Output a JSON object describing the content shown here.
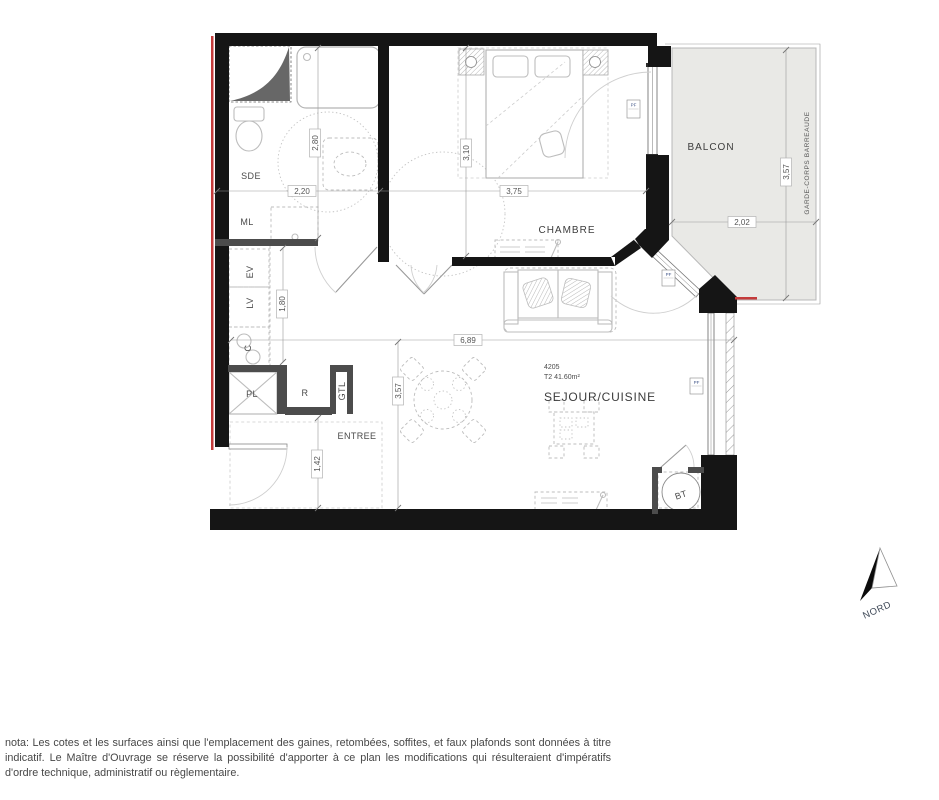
{
  "plan": {
    "unit": {
      "number": "4205",
      "type_area": "T2 41.60m²"
    },
    "rooms": {
      "balcony": "BALCON",
      "bedroom": "CHAMBRE",
      "living_kitchen": "SEJOUR/CUISINE",
      "entry": "ENTREE",
      "shower_room": "SDE"
    },
    "equipment": {
      "ml": "ML",
      "ev": "EV",
      "lv": "LV",
      "c": "C",
      "pl": "PL",
      "r": "R",
      "gtl": "GTL",
      "bt": "BT"
    },
    "dimensions": {
      "sde_width": "2,20",
      "sde_depth": "2,80",
      "bedroom_depth": "3,10",
      "bedroom_width": "3,75",
      "kitchen_run": "1,80",
      "living_width": "6,89",
      "living_depth": "3,57",
      "entry_depth": "1,42",
      "balcony_depth": "3,57",
      "balcony_width": "2,02"
    },
    "balcony_railing": "GARDE-CORPS BARREAUDE",
    "window_tag": "PF",
    "north_label": "NORD",
    "colors": {
      "wall": "#151515",
      "accent_red": "#c43b3b",
      "balcony_fill": "#e9e9e6"
    }
  },
  "nota": {
    "text": "nota: Les cotes et les surfaces ainsi que l'emplacement des gaines, retombées, soffites, et faux plafonds sont données à titre indicatif. Le Maître d'Ouvrage se réserve la possibilité d'apporter à ce plan les modifications qui résulteraient d'impératifs d'ordre technique, administratif ou règlementaire."
  }
}
